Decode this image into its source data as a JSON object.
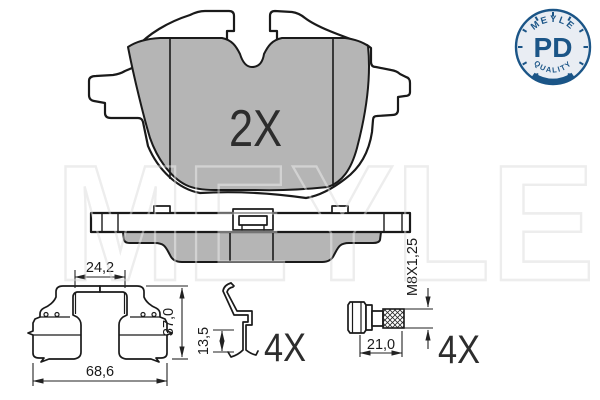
{
  "watermark": {
    "text": "MEYLE"
  },
  "badge": {
    "arc_top": "MEYLE",
    "code": "PD",
    "arc_bottom": "QUALITY"
  },
  "views": {
    "pad_front": {
      "quantity": "2X"
    },
    "fitting_kit": {
      "dims": {
        "inner_width": "24,2",
        "height": "37,0",
        "overall_width": "68,6"
      }
    },
    "retaining_clip": {
      "dims": {
        "height": "13,5"
      },
      "quantity": "4X"
    },
    "guide_screw": {
      "dims": {
        "length": "21,0",
        "thread": "M8X1,25"
      },
      "quantity": "4X"
    }
  },
  "colors": {
    "friction_gray": "#b5b5b5",
    "line": "#1a1a1a",
    "badge_blue": "#1b5587",
    "badge_bg": "#e9edf3",
    "watermark_gray": "#e2e2e2"
  }
}
